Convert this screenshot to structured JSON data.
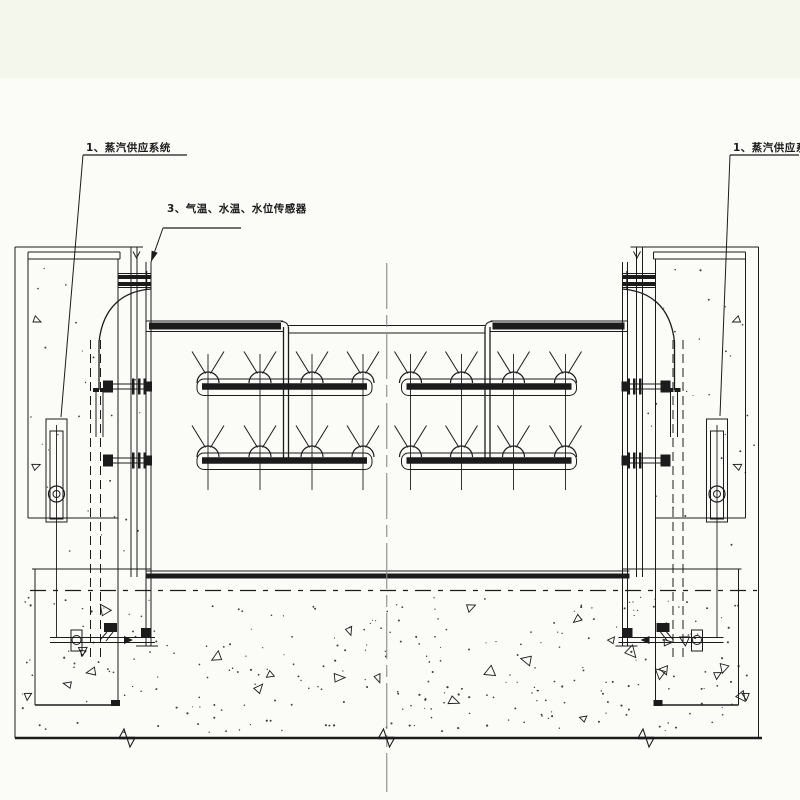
{
  "page": {
    "background": "#fbfcf8",
    "margin_band_color": "#f3f7ec",
    "line_color": "#1b1b1b",
    "centerline_color": "#8a8a8a"
  },
  "callouts": [
    {
      "label": "1、蒸汽供应系统",
      "underline": [
        83,
        155,
        187,
        155
      ],
      "leader_end": [
        61,
        417
      ],
      "arrow": false
    },
    {
      "label": "3、气温、水温、水位传感器",
      "underline": [
        163,
        228,
        241,
        228
      ],
      "leader_end": [
        151,
        262
      ],
      "arrow": true
    },
    {
      "label": "1、蒸汽供应系统",
      "underline": [
        730,
        155,
        799,
        155
      ],
      "leader_end": [
        720,
        416
      ],
      "arrow": false
    }
  ],
  "drawing": {
    "seed": 7,
    "mirror_axis_x": 386.75,
    "margin_band": {
      "x": 0,
      "y": 0,
      "w": 800,
      "h": 78
    },
    "centerline": {
      "x": 386.75,
      "y1": 263,
      "y2": 792
    },
    "gate": {
      "left_edge_x": [
        146,
        151
      ],
      "top": 320,
      "bottom": 578,
      "top_band": {
        "thick_x1": 149,
        "thick_x2": 281,
        "y_top": 321,
        "y_bot": 331.5
      },
      "mid_lines_y": [
        325.5,
        333
      ],
      "mid_x1": 288.5,
      "drop_pipe_x": [
        283.5,
        288.5
      ],
      "rows_y": [
        386.5,
        460.5
      ],
      "panel": {
        "x1": 197,
        "x2": 372
      },
      "nozzle_x": [
        208,
        260,
        312,
        363
      ],
      "nozzle": {
        "dome_r": 11,
        "v_spread": 16,
        "v_rise": 22,
        "col_top": 354,
        "col_bottom": 490
      },
      "bottom_bar": {
        "x1": 146,
        "x2": 629.5,
        "y": 573.5,
        "h": 5
      }
    },
    "pier": {
      "outer_x": 15,
      "inner_x": 28,
      "top_y": 247,
      "wall_bottom_y": 738,
      "cap": {
        "x1": 28,
        "x2": 120,
        "y1": 252,
        "y2": 259
      },
      "vmark": [
        133,
        251.5,
        140,
        258
      ],
      "slot_solid_x": [
        118,
        131,
        137
      ],
      "slot_dashed_x": [
        90.5,
        100.5
      ],
      "cylinder": {
        "x": 46,
        "y": 419,
        "w": 21,
        "h": 103
      },
      "platform_y": [
        518,
        569
      ],
      "pit": {
        "x1": 35,
        "x2": 118,
        "y_top": 569,
        "y_bot": 705
      },
      "top_pipes_y": [
        275,
        282
      ],
      "valve_pipe_y": 640,
      "tri_marks": [
        [
          37,
          320
        ],
        [
          36,
          466
        ],
        [
          28,
          696
        ]
      ]
    },
    "floor": {
      "chain_y": 590.5,
      "bottom_y": 738,
      "breaks_x": [
        127,
        386.5,
        646
      ],
      "dots_region": [
        22,
        597,
        756,
        733
      ],
      "dots": 270,
      "triangles": 26,
      "pier_dots_left": [
        20,
        262,
        142,
        556
      ],
      "pier_dots_right": [
        634,
        262,
        756,
        556
      ],
      "pier_dot_count": 26
    }
  }
}
